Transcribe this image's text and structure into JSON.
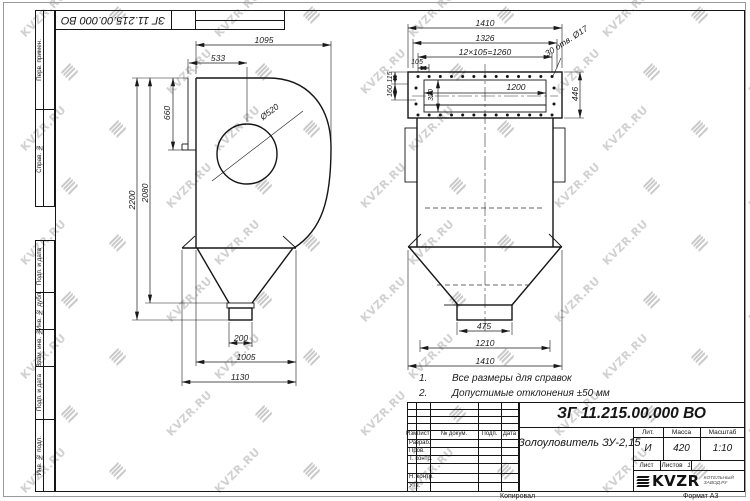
{
  "page": {
    "corner_doc_number": "ЗГ 11.215.00.000 ВО",
    "copied_label": "Копировал",
    "format_label": "Формат А3"
  },
  "watermark": {
    "text": "KVZR.RU"
  },
  "margin_stamps": {
    "perv": "Перв. примен.",
    "sprav": "Справ. №",
    "podp1": "Подп. и дата",
    "inv_dubl": "Инв. № дубл.",
    "vzam": "Взам. инв. №",
    "podp2": "Подп. и дата",
    "inv_podl": "Инв. № подл."
  },
  "left_view": {
    "dims": {
      "overall_width": "1095",
      "inlet_offset": "533",
      "inlet_height": "660",
      "drum_dia": "Ø520",
      "total_height": "2200",
      "body_height": "2080",
      "outlet_width": "200",
      "hopper_width": "1005",
      "base_width": "1130"
    }
  },
  "front_view": {
    "dims": {
      "top_total": "1410",
      "flange_width": "1326",
      "hole_pitch": "12×105=1260",
      "edge_pitch": "105",
      "holes_callout": "30 отв. Ø17",
      "opening_width": "1200",
      "flange_height": "446",
      "top_offset": "115",
      "side_offset": "160",
      "opening_height": "320",
      "outlet_width": "475",
      "hopper_width": "1210",
      "bottom_total": "1410"
    }
  },
  "notes": {
    "n1_num": "1.",
    "n1_text": "Все размеры для справок",
    "n2_num": "2.",
    "n2_text": "Допустимые отклонения  ±50 мм"
  },
  "title_block": {
    "doc_number": "ЗГ 11.215.00.000  ВО",
    "product_name": "Золоуловитель ЗУ-2,15",
    "cols": {
      "izm": "Изм.",
      "list": "Лист",
      "doc": "№ докум.",
      "podp": "Подп.",
      "data": "Дата"
    },
    "rows": {
      "razrab": "Разраб.",
      "prov": "Пров.",
      "tkontr": "Т. контр.",
      "nkontr": "Н. контр.",
      "utv": "Утв."
    },
    "lit_label": "Лит.",
    "lit_value": "И",
    "mass_label": "Масса",
    "mass_value": "420",
    "scale_label": "Масштаб",
    "scale_value": "1:10",
    "sheet_label": "Лист",
    "sheets_label": "Листов",
    "sheets_value": "1",
    "logo_text": "KVZR",
    "logo_sub1": "КОТЕЛЬНЫЙ",
    "logo_sub2": "ЗАВОД.РУ"
  }
}
